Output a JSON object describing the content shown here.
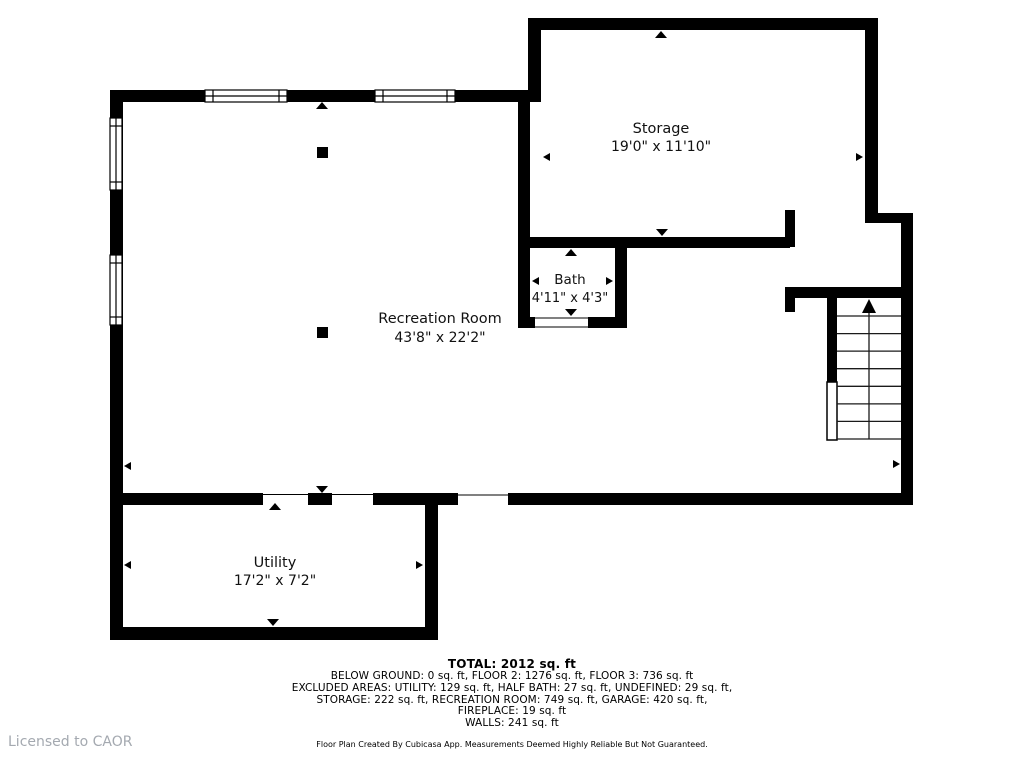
{
  "colors": {
    "wall": "#000000",
    "background": "#ffffff",
    "label_text": "#111111",
    "license_text": "#a4a9b0"
  },
  "rooms": {
    "storage": {
      "name": "Storage",
      "dimensions": "19'0\" x 11'10\""
    },
    "bath": {
      "name": "Bath",
      "dimensions": "4'11\" x 4'3\""
    },
    "recreation": {
      "name": "Recreation Room",
      "dimensions": "43'8\" x 22'2\""
    },
    "utility": {
      "name": "Utility",
      "dimensions": "17'2\" x 7'2\""
    }
  },
  "stairs": {
    "direction": "up"
  },
  "summary": {
    "total": "TOTAL: 2012 sq. ft",
    "lines": [
      "BELOW GROUND: 0 sq. ft, FLOOR 2: 1276 sq. ft, FLOOR 3: 736 sq. ft",
      "EXCLUDED AREAS: UTILITY: 129 sq. ft, HALF BATH: 27 sq. ft, UNDEFINED: 29 sq. ft,",
      "STORAGE: 222 sq. ft, RECREATION ROOM: 749 sq. ft, GARAGE: 420 sq. ft,",
      "FIREPLACE: 19 sq. ft",
      "WALLS: 241 sq. ft"
    ]
  },
  "footer": {
    "disclaimer": "Floor Plan Created By Cubicasa App. Measurements Deemed Highly Reliable But Not Guaranteed.",
    "license": "Licensed to CAOR"
  }
}
